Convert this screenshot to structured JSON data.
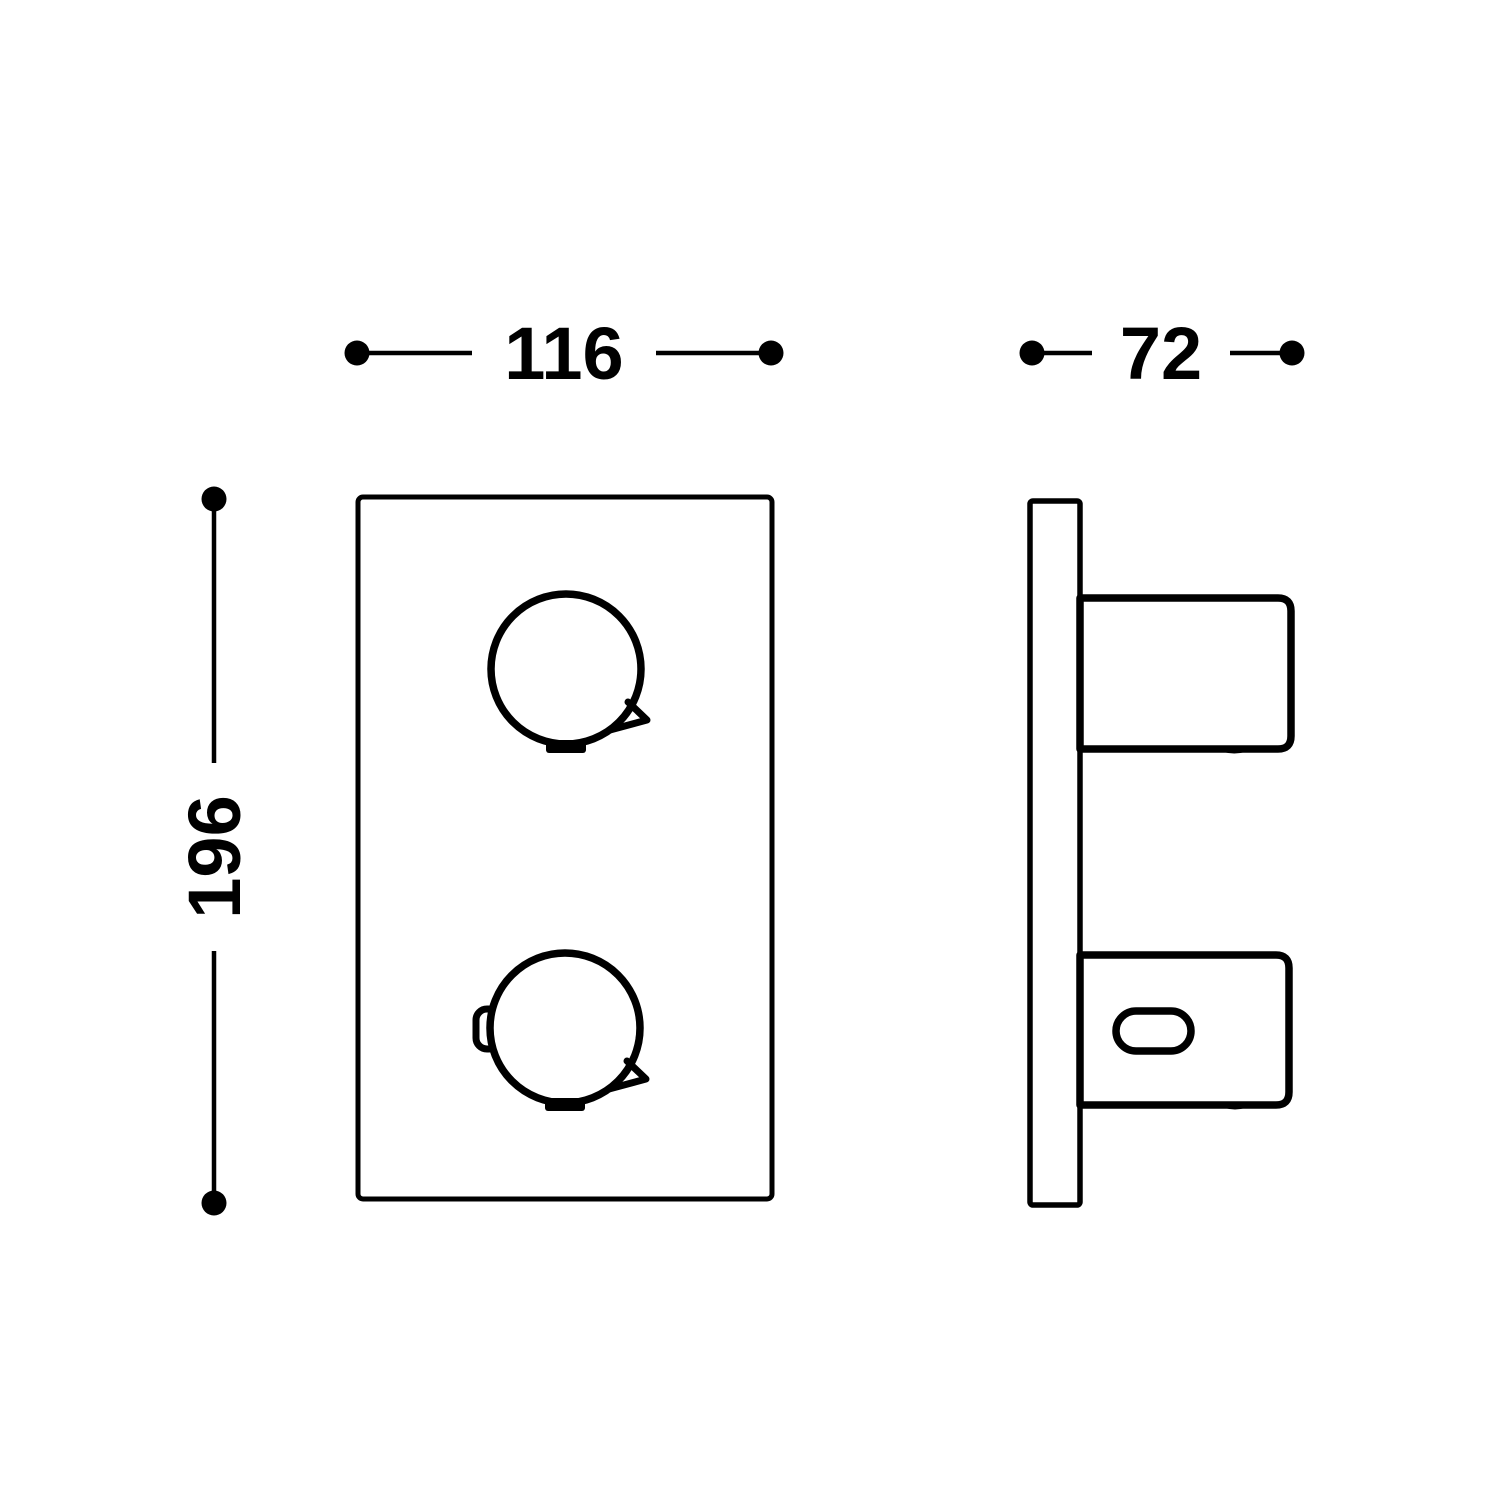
{
  "drawing": {
    "background_color": "#ffffff",
    "line_color": "#000000",
    "dimensions": {
      "width": {
        "label": "116"
      },
      "depth": {
        "label": "72"
      },
      "height": {
        "label": "196"
      }
    }
  }
}
